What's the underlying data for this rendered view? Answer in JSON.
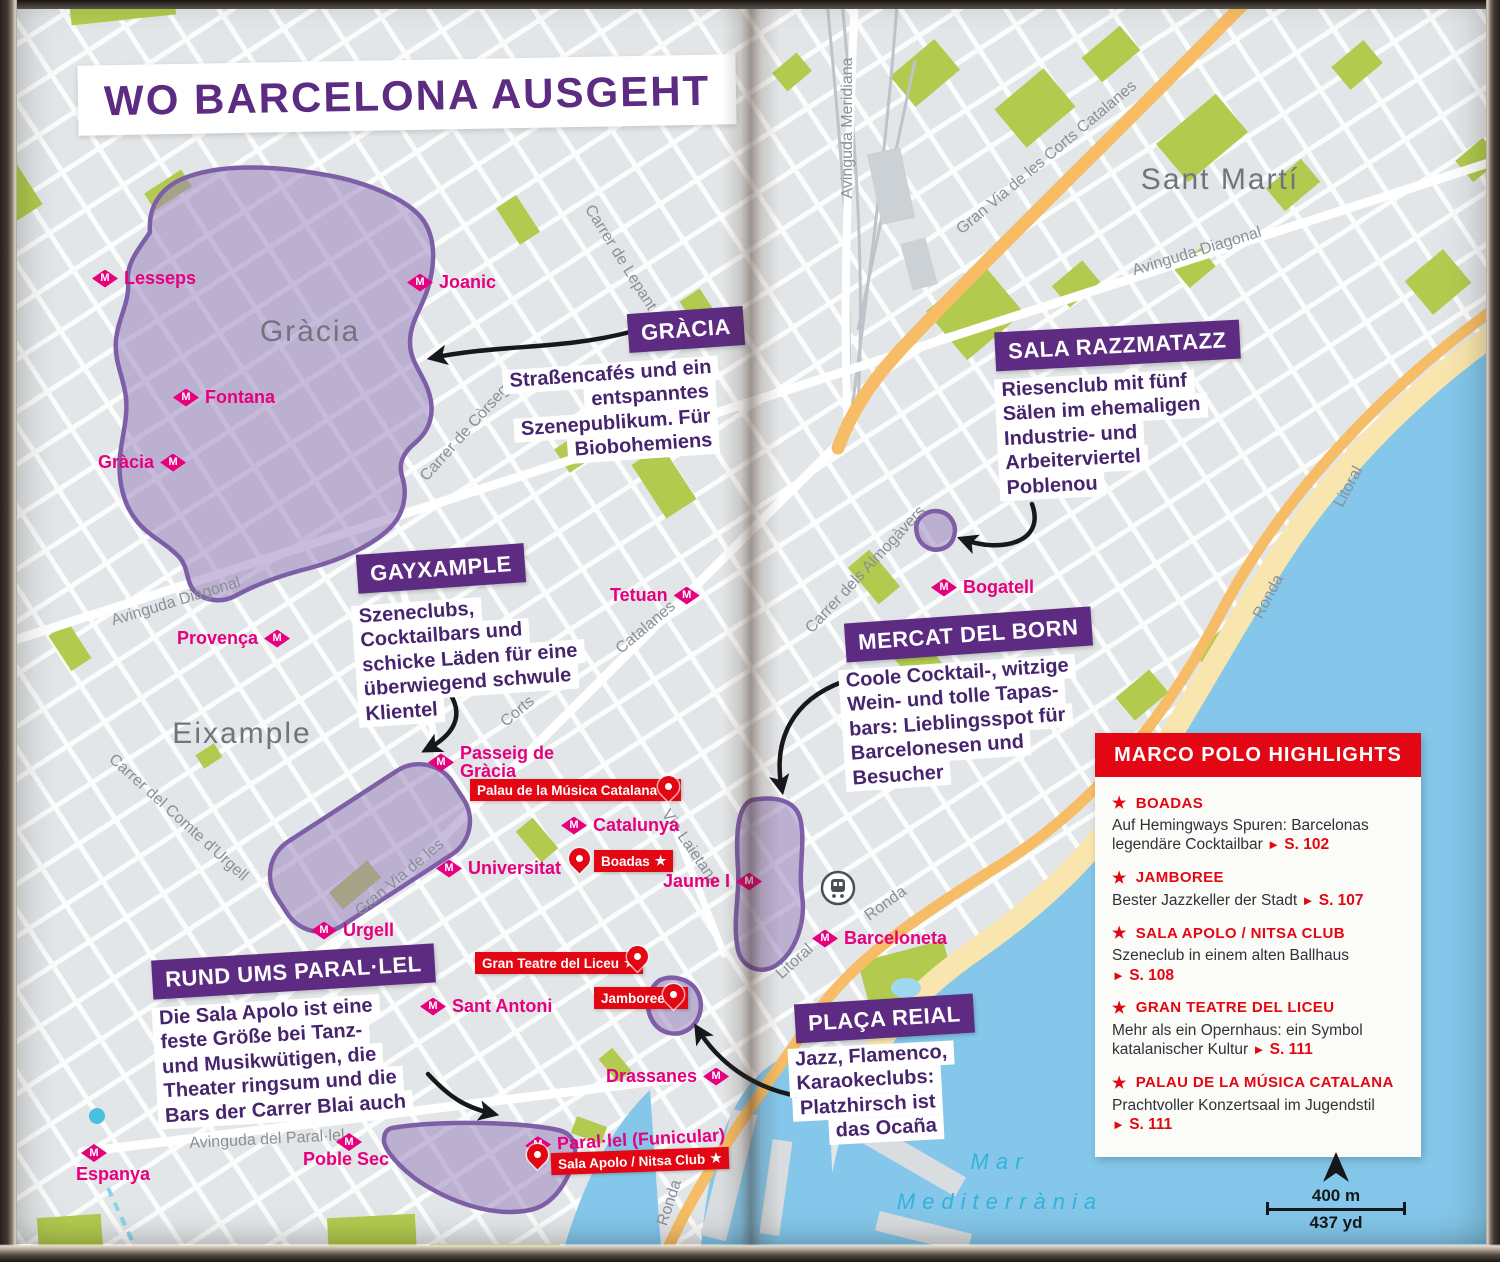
{
  "title": "WO BARCELONA AUSGEHT",
  "districts": [
    {
      "name": "Gràcia"
    },
    {
      "name": "Eixample"
    },
    {
      "name": "Sant Martí"
    }
  ],
  "sea": {
    "line1": "Mar",
    "line2": "Mediterrània"
  },
  "callouts": [
    {
      "id": "gracia",
      "title": "GRÀCIA",
      "lines": [
        "Straßencafés und ein",
        "entspanntes",
        "Szenepublikum. Für",
        "Biobohemiens"
      ]
    },
    {
      "id": "sala-razzmatazz",
      "title": "SALA RAZZMATAZZ",
      "lines": [
        "Riesenclub mit fünf",
        "Sälen im ehemaligen",
        "Industrie- und",
        "Arbeiterviertel",
        "Poblenou"
      ]
    },
    {
      "id": "gayxample",
      "title": "GAYXAMPLE",
      "lines": [
        "Szeneclubs,",
        "Cocktailbars und",
        "schicke Läden für eine",
        "überwiegend schwule",
        "Klientel"
      ]
    },
    {
      "id": "mercat-del-born",
      "title": "MERCAT DEL BORN",
      "lines": [
        "Coole Cocktail-, witzige",
        "Wein- und tolle Tapas-",
        "bars: Lieblingsspot für",
        "Barcelonesen und",
        "Besucher"
      ]
    },
    {
      "id": "rund-ums-parallel",
      "title": "RUND UMS PARAL·LEL",
      "lines": [
        "Die Sala Apolo ist eine",
        "feste Größe bei Tanz-",
        "und Musikwütigen, die",
        "Theater ringsum und die",
        "Bars der Carrer Blai auch"
      ]
    },
    {
      "id": "placa-reial",
      "title": "PLAÇA REIAL",
      "lines": [
        "Jazz, Flamenco,",
        "Karaokeclubs:",
        "Platzhirsch ist",
        "das Ocaña"
      ]
    }
  ],
  "metro_stations": [
    {
      "name": "Lesseps"
    },
    {
      "name": "Joanic"
    },
    {
      "name": "Fontana"
    },
    {
      "name": "Gràcia"
    },
    {
      "name": "Provença"
    },
    {
      "name": "Tetuan"
    },
    {
      "name": "Passeig de\nGràcia"
    },
    {
      "name": "Catalunya"
    },
    {
      "name": "Universitat"
    },
    {
      "name": "Urgell"
    },
    {
      "name": "Jaume I"
    },
    {
      "name": "Barceloneta"
    },
    {
      "name": "Sant Antoni"
    },
    {
      "name": "Drassanes"
    },
    {
      "name": "Paral·lel (Funicular)"
    },
    {
      "name": "Poble Sec"
    },
    {
      "name": "Espanya"
    },
    {
      "name": "Bogatell"
    }
  ],
  "pois": [
    {
      "name": "Palau de la Música Catalana"
    },
    {
      "name": "Boadas"
    },
    {
      "name": "Gran Teatre del Liceu"
    },
    {
      "name": "Jamboree"
    },
    {
      "name": "Sala Apolo / Nitsa Club"
    }
  ],
  "streets": [
    {
      "name": "Avinguda Meridiana"
    },
    {
      "name": "Gran Via de les Corts Catalanes"
    },
    {
      "name": "Avinguda Diagonal"
    },
    {
      "name": "Avinguda Diagonal"
    },
    {
      "name": "Carrer de Lepant"
    },
    {
      "name": "Carrer de Còrsega"
    },
    {
      "name": "Carrer del Comte d'Urgell"
    },
    {
      "name": "Gran Via de les"
    },
    {
      "name": "Corts"
    },
    {
      "name": "Catalanes"
    },
    {
      "name": "Via Laietana"
    },
    {
      "name": "Carrer dels Almogàvers"
    },
    {
      "name": "Ronda"
    },
    {
      "name": "Litoral"
    },
    {
      "name": "Litoral"
    },
    {
      "name": "Ronda"
    },
    {
      "name": "Ronda"
    },
    {
      "name": "Avinguda del Paral·lel"
    }
  ],
  "highlights": {
    "header": "MARCO POLO HIGHLIGHTS",
    "items": [
      {
        "title": "BOADAS",
        "desc": "Auf Hemingways Spuren: Barcelonas legendäre Cocktailbar",
        "page": "S. 102"
      },
      {
        "title": "JAMBOREE",
        "desc": "Bester Jazzkeller der Stadt",
        "page": "S. 107"
      },
      {
        "title": "SALA APOLO / NITSA CLUB",
        "desc": "Szeneclub in einem alten Ballhaus",
        "page": "S. 108"
      },
      {
        "title": "GRAN TEATRE DEL LICEU",
        "desc": "Mehr als ein Opernhaus: ein Symbol katalanischer Kultur",
        "page": "S. 111"
      },
      {
        "title": "PALAU DE LA MÚSICA CATALANA",
        "desc": "Prachtvoller Konzertsaal im Jugendstil",
        "page": "S. 111"
      }
    ]
  },
  "scale": {
    "metric": "400 m",
    "imperial": "437 yd"
  },
  "icons": {
    "metro_letter": "M",
    "poi_star": "★",
    "highlight_star": "★",
    "page_arrow": "►"
  },
  "colors": {
    "banner_purple": "#5d2b82",
    "text_purple": "#46246e",
    "metro_magenta": "#e6007e",
    "marco_polo_red": "#e30613",
    "water_blue": "#84c7ea",
    "park_green": "#b2cb4f",
    "road_orange": "#f6bd66",
    "district_blob_purple": "#7e5ea6"
  }
}
